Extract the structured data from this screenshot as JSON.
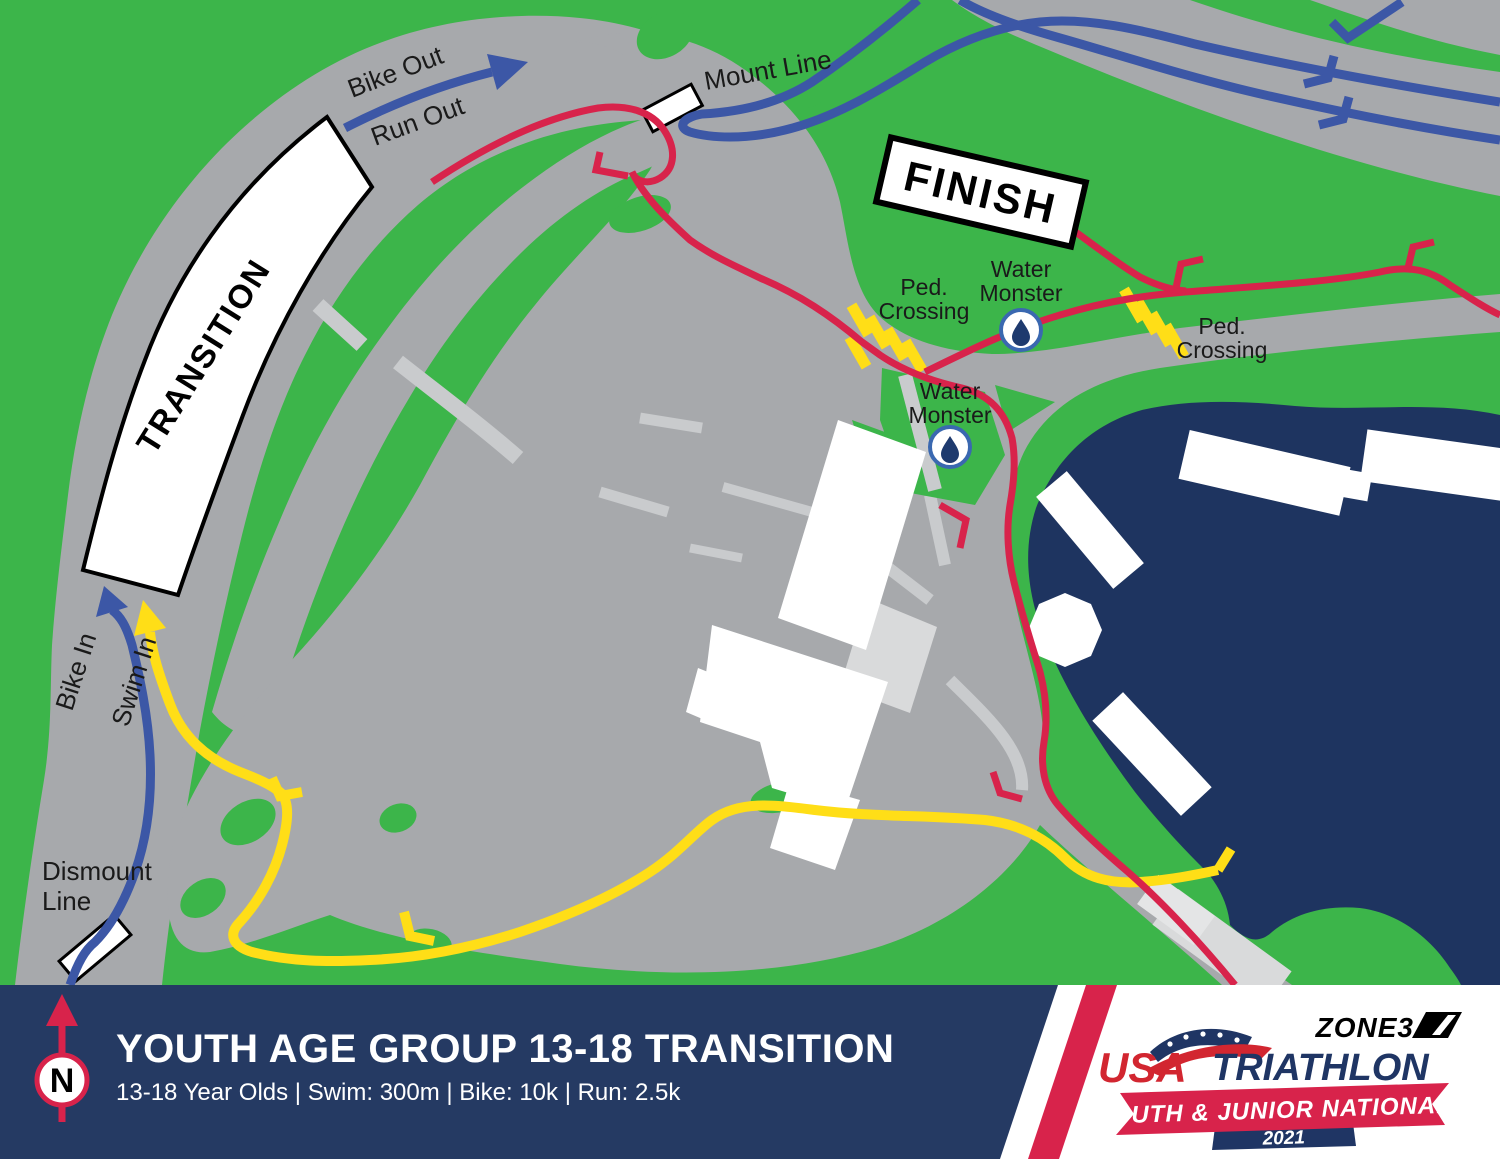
{
  "map": {
    "labels": {
      "bike_out": "Bike Out",
      "run_out": "Run Out",
      "mount_line": "Mount Line",
      "finish": "FINISH",
      "transition": "TRANSITION",
      "bike_in": "Bike In",
      "swim_in": "Swim In",
      "dismount_line1": "Dismount",
      "dismount_line2": "Line",
      "ped_crossing_line1": "Ped.",
      "ped_crossing_line2": "Crossing",
      "water_monster_line1": "Water",
      "water_monster_line2": "Monster"
    },
    "colors": {
      "grass": "#3CB54A",
      "road": "#A7A9AC",
      "path_light": "#C9CBCD",
      "water": "#1E3460",
      "bike_route": "#3C57A6",
      "run_route": "#D8234B",
      "swim_route": "#FFDE17",
      "sign_fill": "#FFFFFF",
      "label_text": "#1A1A1A"
    }
  },
  "footer": {
    "title": "YOUTH AGE GROUP 13-18 TRANSITION",
    "subtitle": "13-18 Year Olds | Swim: 300m | Bike: 10k | Run: 2.5k",
    "north_label": "N",
    "colors": {
      "bar": "#253A63",
      "accent": "#D8234B"
    },
    "logos": {
      "zone3": "ZONE3",
      "usa": "USA",
      "triathlon": "TRIATHLON",
      "banner": "YOUTH & JUNIOR NATIONALS",
      "year": "2021"
    }
  }
}
